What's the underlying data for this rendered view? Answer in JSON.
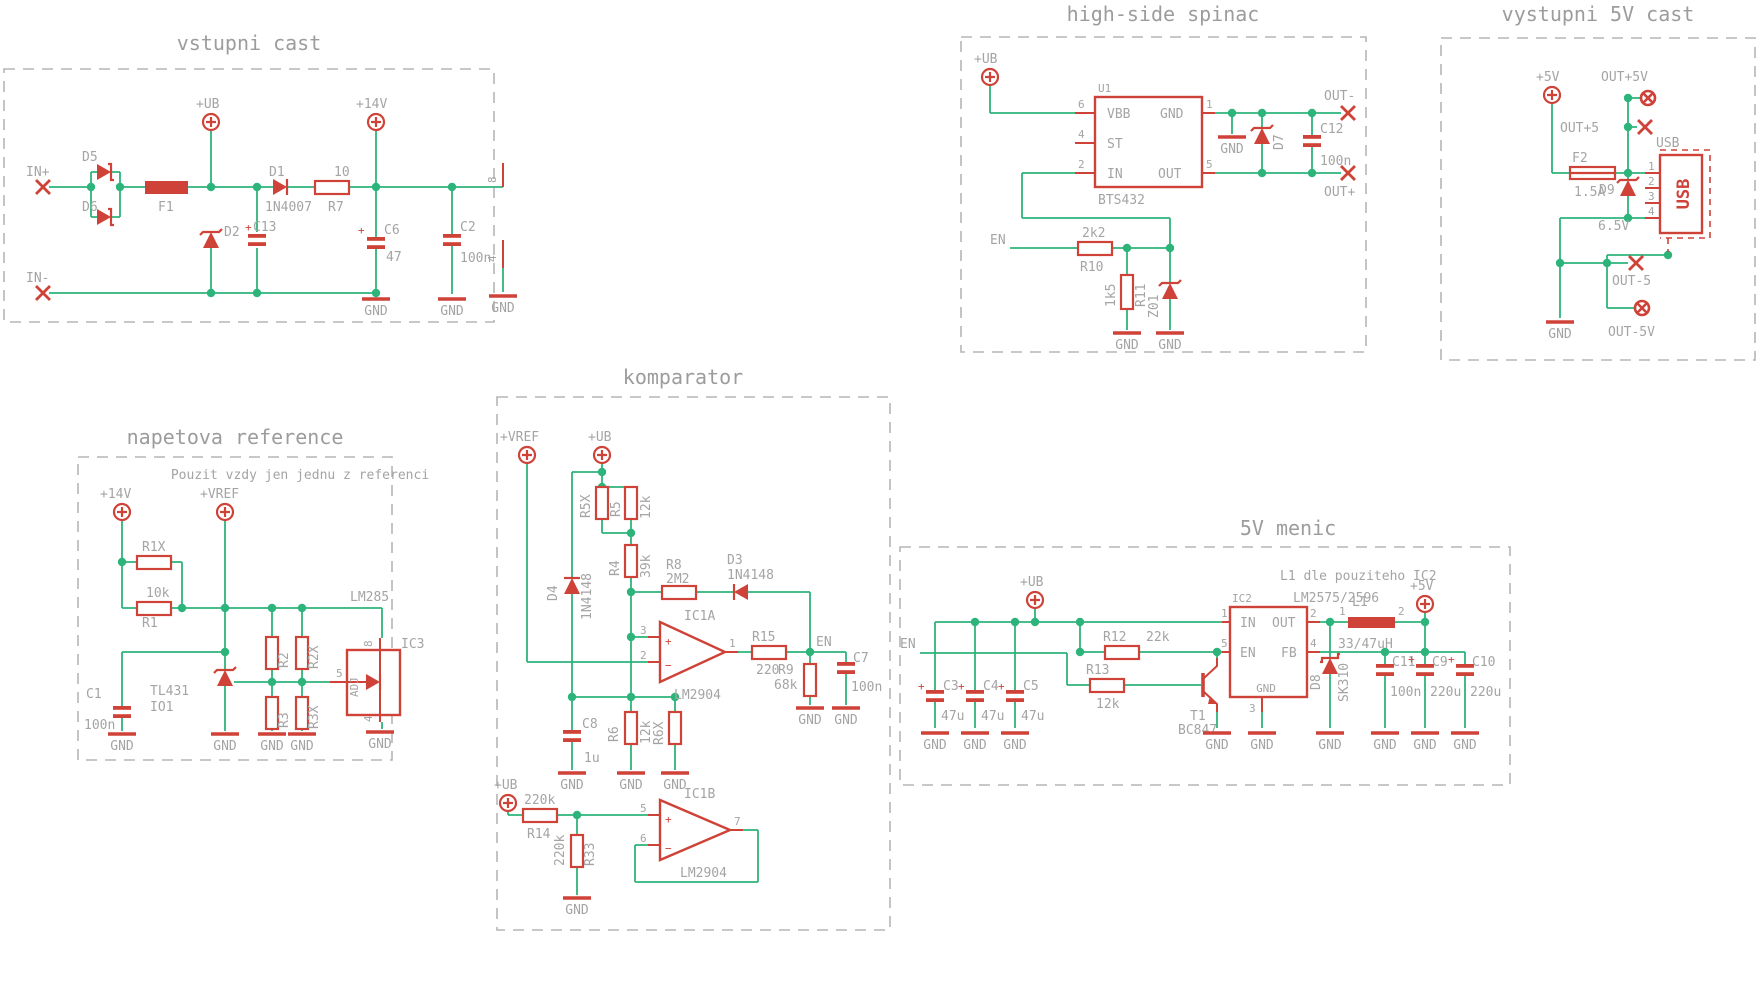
{
  "colors": {
    "wire": "#2db47b",
    "symbol": "#cf4238",
    "text": "#a4a4a4",
    "frame": "#b5b5b5",
    "background": "#ffffff"
  },
  "common": {
    "gnd": "GND",
    "plus": "+",
    "ub": "+UB",
    "v14": "+14V",
    "v5": "+5V",
    "vref": "+VREF",
    "en": "EN",
    "c100n": "100n",
    "r12k": "12k",
    "r220k": "220k",
    "c220u": "220u",
    "c47u": "47u",
    "lm2904": "LM2904",
    "d1n4148": "1N4148"
  },
  "sections": {
    "input": {
      "title": "vstupni cast",
      "in_plus": "IN+",
      "in_minus": "IN-",
      "d5": "D5",
      "d6": "D6",
      "f1": "F1",
      "d2": "D2",
      "c13": "C13",
      "d1": "D1",
      "d1_val": "1N4007",
      "r7": "R7",
      "r7_val": "10",
      "c6": "C6",
      "c6_val": "47",
      "c2": "C2",
      "pin8": "8",
      "pin4": "4"
    },
    "reference": {
      "title": "napetova reference",
      "note": "Pouzit vzdy jen jednu z referenci",
      "r1x": "R1X",
      "r1": "R1",
      "r1_val": "10k",
      "tl431": "TL431",
      "io1": "IO1",
      "c1": "C1",
      "r2": "R2",
      "r2x": "R2X",
      "r3": "R3",
      "r3x": "R3X",
      "lm285": "LM285",
      "ic3": "IC3",
      "adj": "ADJ",
      "pin8": "8",
      "pin5": "5",
      "pin4": "4"
    },
    "comparator": {
      "title": "komparator",
      "r5x": "R5X",
      "r5": "R5",
      "r4": "R4",
      "r4_val": "39k",
      "d4": "D4",
      "r8": "R8",
      "r8_val": "2M2",
      "d3": "D3",
      "ic1a": "IC1A",
      "ic1b": "IC1B",
      "pin3": "3",
      "pin2": "2",
      "pin1": "1",
      "pin5": "5",
      "pin6": "6",
      "pin7": "7",
      "plus": "+",
      "minus": "−",
      "r15": "R15",
      "r15_val": "220",
      "r9": "R9",
      "r9_val": "68k",
      "c7": "C7",
      "c8": "C8",
      "c8_val": "1u",
      "r6": "R6",
      "r6x": "R6X",
      "r14": "R14",
      "r33": "R33"
    },
    "highside": {
      "title": "high-side spinac",
      "u1": "U1",
      "u1_val": "BTS432",
      "vbb": "VBB",
      "st": "ST",
      "in_pin": "IN",
      "out_pin": "OUT",
      "p6": "6",
      "p4": "4",
      "p2": "2",
      "p1": "1",
      "p5": "5",
      "r10": "R10",
      "r10_val": "2k2",
      "r11": "R11",
      "r11_val": "1k5",
      "z01": "Z01",
      "d7": "D7",
      "c12": "C12",
      "out_minus": "OUT-",
      "out_plus": "OUT+"
    },
    "output5v": {
      "title": "vystupni 5V cast",
      "out5v_pos": "OUT+5V",
      "out5_pos": "OUT+5",
      "f2": "F2",
      "f2_val": "1.5A",
      "d9": "D9",
      "d9_val": "6.5V",
      "usb": "USB",
      "p1": "1",
      "p2": "2",
      "p3": "3",
      "p4": "4",
      "out5_neg": "OUT-5",
      "out5v_neg": "OUT-5V"
    },
    "converter": {
      "title": "5V menic",
      "note": "L1 dle pouziteho IC2",
      "ic2": "IC2",
      "ic2_val": "LM2575/2596",
      "in_pin": "IN",
      "out_pin": "OUT",
      "fb": "FB",
      "p1": "1",
      "p2": "2",
      "p3": "3",
      "p4": "4",
      "p5": "5",
      "r12": "R12",
      "r12_val": "22k",
      "r13": "R13",
      "t1": "T1",
      "t1_val": "BC847",
      "c3": "C3",
      "c4": "C4",
      "c5": "C5",
      "d8": "D8",
      "d8_val": "SK310",
      "l1": "L1",
      "l1_val": "33/47uH",
      "lp1": "1",
      "lp2": "2",
      "c11": "C11",
      "c9": "C9",
      "c10": "C10"
    }
  }
}
